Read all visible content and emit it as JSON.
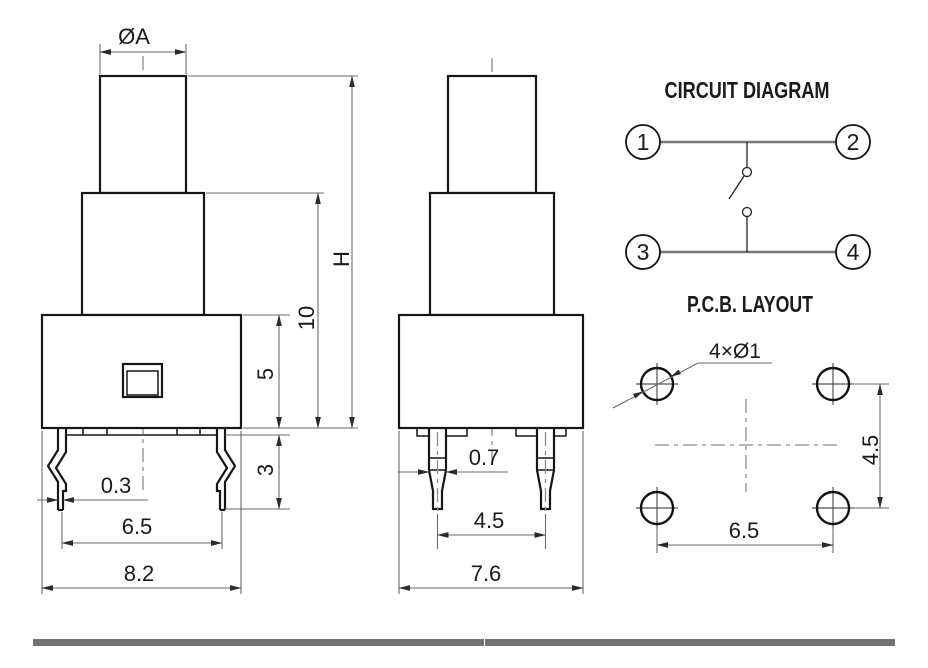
{
  "drawing_title": "push-button switch dimensional drawing",
  "front_view": {
    "dim_cap_diameter": "ØA",
    "dim_total_height": "H",
    "dim_upper_height": "10",
    "dim_body_height": "5",
    "dim_lead_length": "3",
    "dim_lead_thickness": "0.3",
    "dim_lead_span": "6.5",
    "dim_body_width": "8.2"
  },
  "side_view": {
    "dim_pin_width": "0.7",
    "dim_pin_span": "4.5",
    "dim_body_depth": "7.6"
  },
  "circuit_diagram": {
    "title": "CIRCUIT DIAGRAM",
    "terminals": [
      "1",
      "2",
      "3",
      "4"
    ]
  },
  "pcb_layout": {
    "title": "P.C.B. LAYOUT",
    "hole_callout": "4×Ø1",
    "dim_hole_pitch_vertical": "4.5",
    "dim_hole_pitch_horizontal": "6.5"
  },
  "colors": {
    "outline": "#161616",
    "dimension_lines": "#6b6b6b",
    "centerline": "#8c8c8c",
    "footer_bar": "#717171",
    "background": "#ffffff"
  }
}
